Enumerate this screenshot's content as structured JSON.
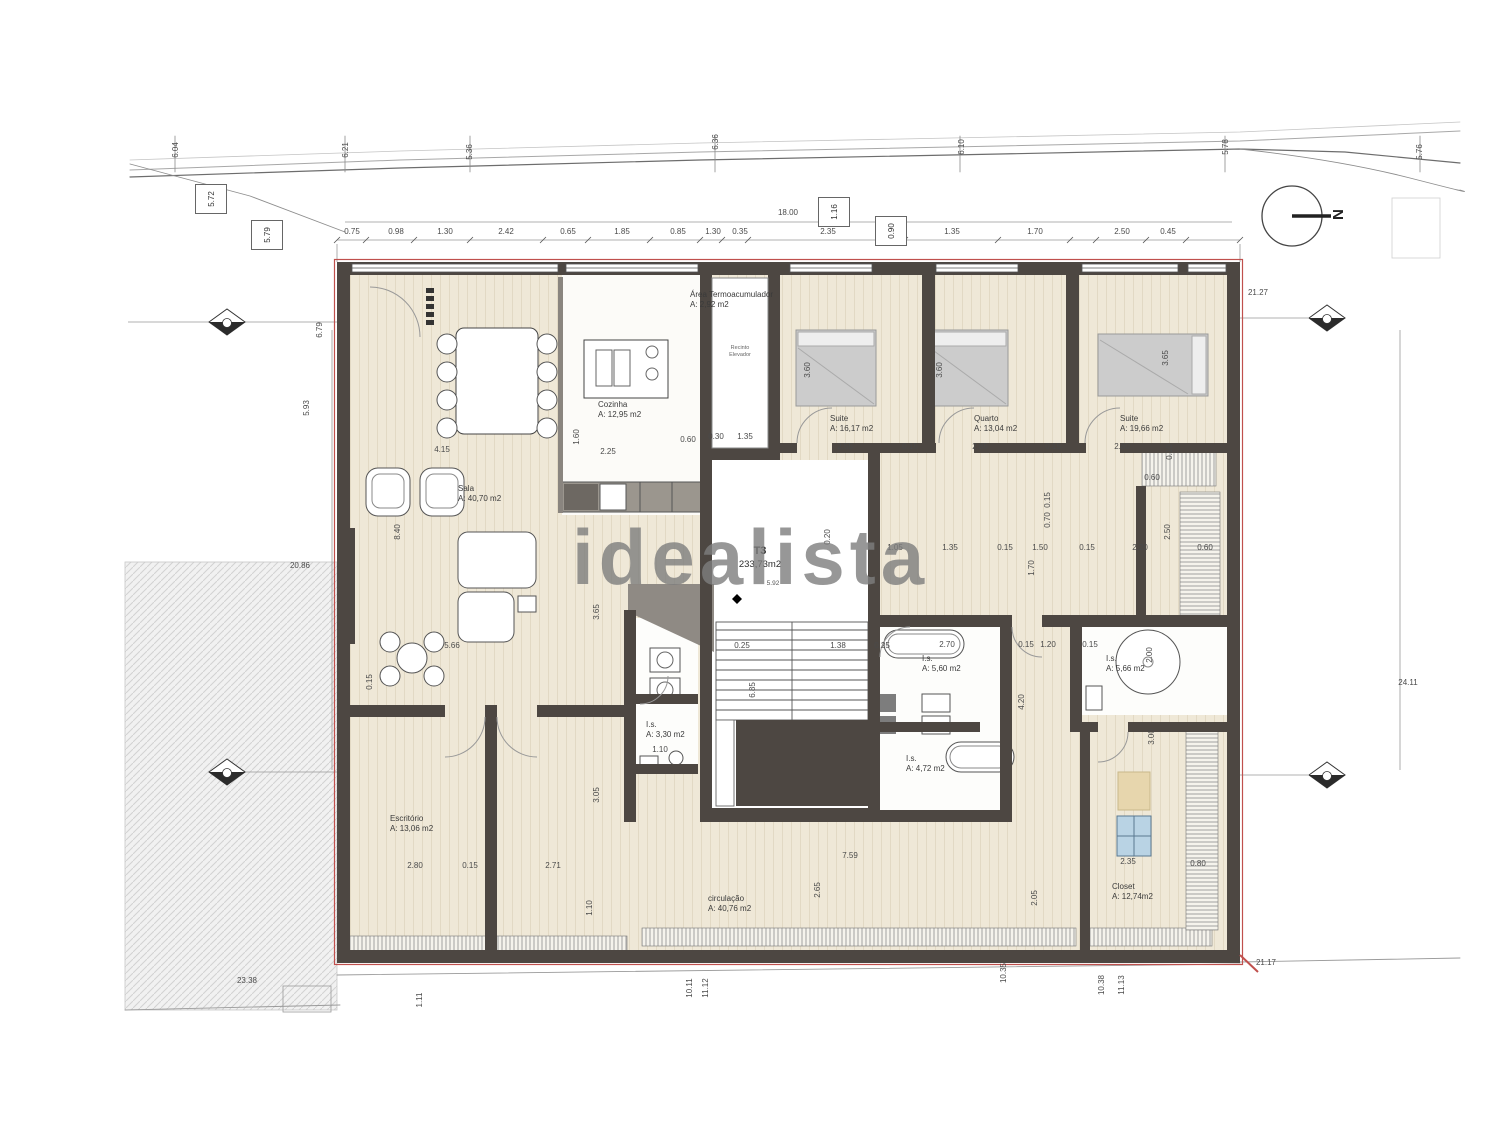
{
  "watermark": "idealista",
  "north": {
    "label": "N"
  },
  "unit": {
    "line1": "T3",
    "line2": "233,73m2",
    "level": "5.92"
  },
  "elevator": {
    "line1": "Recinto",
    "line2": "Elevador"
  },
  "colors": {
    "wall": "#4d4742",
    "floor": "#efe8d7",
    "accent_red": "#c0504d",
    "watermark_gray": "#7e7e7e",
    "bed_gray": "#cccccc",
    "cabinet_blue": "#b9d3e4"
  },
  "rooms": [
    {
      "name": "Cozinha",
      "area": "A: 12,95 m2",
      "x": 598,
      "y": 400
    },
    {
      "name": "Área Termoacumulador",
      "area": "A: 2,92 m2",
      "x": 690,
      "y": 290
    },
    {
      "name": "Suite",
      "area": "A: 16,17 m2",
      "x": 830,
      "y": 414
    },
    {
      "name": "Quarto",
      "area": "A: 13,04 m2",
      "x": 974,
      "y": 414
    },
    {
      "name": "Suite",
      "area": "A: 19,66 m2",
      "x": 1120,
      "y": 414
    },
    {
      "name": "Sala",
      "area": "A: 40,70 m2",
      "x": 458,
      "y": 484
    },
    {
      "name": "Escritório",
      "area": "A: 13,06 m2",
      "x": 390,
      "y": 814
    },
    {
      "name": "circulação",
      "area": "A: 40,76 m2",
      "x": 708,
      "y": 894
    },
    {
      "name": "Closet",
      "area": "A: 12,74m2",
      "x": 1112,
      "y": 882
    },
    {
      "name": "I.s.",
      "area": "A: 5,60 m2",
      "x": 922,
      "y": 654
    },
    {
      "name": "I.s.",
      "area": "A: 5,66 m2",
      "x": 1106,
      "y": 654
    },
    {
      "name": "I.s.",
      "area": "A: 4,72 m2",
      "x": 906,
      "y": 754
    },
    {
      "name": "I.s.",
      "area": "A: 3,30 m2",
      "x": 646,
      "y": 720
    }
  ],
  "axis_boxes": [
    {
      "t": "5.72",
      "x": 211,
      "y": 199,
      "r": 1
    },
    {
      "t": "5.79",
      "x": 267,
      "y": 235,
      "r": 1
    },
    {
      "t": "1.16",
      "x": 834,
      "y": 212,
      "r": 1
    },
    {
      "t": "0.90",
      "x": 891,
      "y": 231,
      "r": 1
    }
  ],
  "dims": [
    {
      "t": "0.75",
      "x": 352,
      "y": 232
    },
    {
      "t": "0.98",
      "x": 396,
      "y": 232
    },
    {
      "t": "1.30",
      "x": 445,
      "y": 232
    },
    {
      "t": "2.42",
      "x": 506,
      "y": 232
    },
    {
      "t": "0.65",
      "x": 568,
      "y": 232
    },
    {
      "t": "1.85",
      "x": 622,
      "y": 232
    },
    {
      "t": "0.85",
      "x": 678,
      "y": 232
    },
    {
      "t": "1.30",
      "x": 713,
      "y": 232
    },
    {
      "t": "0.35",
      "x": 740,
      "y": 232
    },
    {
      "t": "2.35",
      "x": 828,
      "y": 232
    },
    {
      "t": "1.35",
      "x": 952,
      "y": 232
    },
    {
      "t": "1.70",
      "x": 1035,
      "y": 232
    },
    {
      "t": "2.50",
      "x": 1122,
      "y": 232
    },
    {
      "t": "0.45",
      "x": 1168,
      "y": 232
    },
    {
      "t": "18.00",
      "x": 788,
      "y": 213
    },
    {
      "t": "4.15",
      "x": 442,
      "y": 450
    },
    {
      "t": "2.25",
      "x": 608,
      "y": 452
    },
    {
      "t": "1.60",
      "x": 577,
      "y": 437,
      "r": 1
    },
    {
      "t": "0.60",
      "x": 688,
      "y": 440
    },
    {
      "t": "0.30",
      "x": 716,
      "y": 437
    },
    {
      "t": "1.35",
      "x": 745,
      "y": 437
    },
    {
      "t": "2.55",
      "x": 845,
      "y": 447
    },
    {
      "t": "0.15",
      "x": 910,
      "y": 447
    },
    {
      "t": "2.85",
      "x": 980,
      "y": 447
    },
    {
      "t": "0.15",
      "x": 1053,
      "y": 447
    },
    {
      "t": "2.80",
      "x": 1122,
      "y": 447
    },
    {
      "t": "0.10",
      "x": 1170,
      "y": 452,
      "r": 1
    },
    {
      "t": "0.60",
      "x": 1152,
      "y": 478
    },
    {
      "t": "3.60",
      "x": 808,
      "y": 370,
      "r": 1
    },
    {
      "t": "3.60",
      "x": 940,
      "y": 370,
      "r": 1
    },
    {
      "t": "3.65",
      "x": 1166,
      "y": 358,
      "r": 1
    },
    {
      "t": "1.05",
      "x": 895,
      "y": 548
    },
    {
      "t": "1.35",
      "x": 950,
      "y": 548
    },
    {
      "t": "0.15",
      "x": 1005,
      "y": 548
    },
    {
      "t": "1.50",
      "x": 1040,
      "y": 548
    },
    {
      "t": "0.15",
      "x": 1087,
      "y": 548
    },
    {
      "t": "2.20",
      "x": 1140,
      "y": 548
    },
    {
      "t": "0.60",
      "x": 1205,
      "y": 548
    },
    {
      "t": "0.20",
      "x": 828,
      "y": 537,
      "r": 1
    },
    {
      "t": "1.70",
      "x": 1032,
      "y": 568,
      "r": 1
    },
    {
      "t": "0.15",
      "x": 1048,
      "y": 500,
      "r": 1
    },
    {
      "t": "0.70",
      "x": 1048,
      "y": 520,
      "r": 1
    },
    {
      "t": "2.50",
      "x": 1168,
      "y": 532,
      "r": 1
    },
    {
      "t": "0.25",
      "x": 742,
      "y": 646
    },
    {
      "t": "1.38",
      "x": 838,
      "y": 646
    },
    {
      "t": "0.25",
      "x": 882,
      "y": 646
    },
    {
      "t": "6.85",
      "x": 753,
      "y": 690,
      "r": 1
    },
    {
      "t": "2.70",
      "x": 947,
      "y": 645
    },
    {
      "t": "0.15",
      "x": 1026,
      "y": 645
    },
    {
      "t": "1.20",
      "x": 1048,
      "y": 645
    },
    {
      "t": "0.15",
      "x": 1090,
      "y": 645
    },
    {
      "t": "2.00",
      "x": 1150,
      "y": 655,
      "r": 1
    },
    {
      "t": "8.40",
      "x": 398,
      "y": 532,
      "r": 1
    },
    {
      "t": "5.66",
      "x": 452,
      "y": 646
    },
    {
      "t": "0.15",
      "x": 370,
      "y": 682,
      "r": 1
    },
    {
      "t": "3.65",
      "x": 597,
      "y": 612,
      "r": 1
    },
    {
      "t": "3.05",
      "x": 597,
      "y": 795,
      "r": 1
    },
    {
      "t": "1.10",
      "x": 590,
      "y": 908,
      "r": 1
    },
    {
      "t": "2.80",
      "x": 415,
      "y": 866
    },
    {
      "t": "0.15",
      "x": 470,
      "y": 866
    },
    {
      "t": "2.71",
      "x": 553,
      "y": 866
    },
    {
      "t": "7.59",
      "x": 850,
      "y": 856
    },
    {
      "t": "2.65",
      "x": 818,
      "y": 890,
      "r": 1
    },
    {
      "t": "2.05",
      "x": 1035,
      "y": 898,
      "r": 1
    },
    {
      "t": "4.20",
      "x": 1022,
      "y": 702,
      "r": 1
    },
    {
      "t": "1.10",
      "x": 660,
      "y": 750
    },
    {
      "t": "2.35",
      "x": 1128,
      "y": 862
    },
    {
      "t": "0.80",
      "x": 1198,
      "y": 864
    },
    {
      "t": "3.00",
      "x": 1152,
      "y": 737,
      "r": 1
    },
    {
      "t": "6.79",
      "x": 320,
      "y": 330,
      "r": 1
    },
    {
      "t": "5.93",
      "x": 307,
      "y": 408,
      "r": 1
    },
    {
      "t": "20.86",
      "x": 300,
      "y": 566
    },
    {
      "t": "23.38",
      "x": 247,
      "y": 981
    },
    {
      "t": "21.27",
      "x": 1258,
      "y": 293
    },
    {
      "t": "24.11",
      "x": 1408,
      "y": 683
    },
    {
      "t": "21.17",
      "x": 1266,
      "y": 963
    },
    {
      "t": "6.04",
      "x": 176,
      "y": 150,
      "r": 1
    },
    {
      "t": "6.21",
      "x": 346,
      "y": 150,
      "r": 1
    },
    {
      "t": "5.36",
      "x": 470,
      "y": 152,
      "r": 1
    },
    {
      "t": "6.36",
      "x": 716,
      "y": 142,
      "r": 1
    },
    {
      "t": "6.10",
      "x": 962,
      "y": 147,
      "r": 1
    },
    {
      "t": "5.78",
      "x": 1226,
      "y": 147,
      "r": 1
    },
    {
      "t": "5.76",
      "x": 1420,
      "y": 152,
      "r": 1
    },
    {
      "t": "10.11",
      "x": 690,
      "y": 988,
      "r": 1
    },
    {
      "t": "11.12",
      "x": 706,
      "y": 988,
      "r": 1
    },
    {
      "t": "10.35",
      "x": 1004,
      "y": 973,
      "r": 1
    },
    {
      "t": "10.38",
      "x": 1102,
      "y": 985,
      "r": 1
    },
    {
      "t": "11.13",
      "x": 1122,
      "y": 985,
      "r": 1
    },
    {
      "t": "1.11",
      "x": 420,
      "y": 1000,
      "r": 1
    }
  ]
}
